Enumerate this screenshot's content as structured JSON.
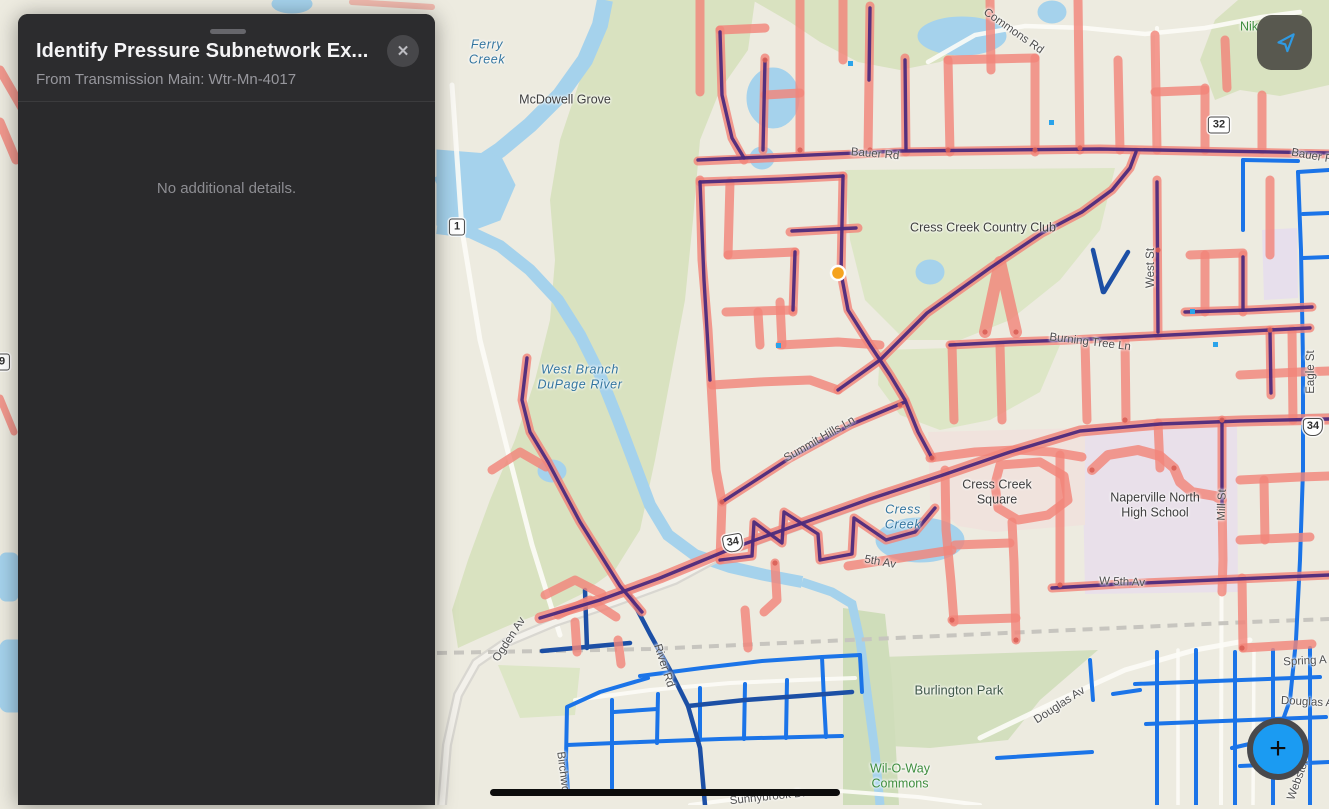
{
  "panel": {
    "title": "Identify Pressure Subnetwork Ex...",
    "subtitle": "From Transmission Main: Wtr-Mn-4017",
    "close_label": "✕",
    "body_text": "No additional details."
  },
  "controls": {
    "locate_icon": "navigation-arrow",
    "add_label": "+"
  },
  "map": {
    "marker_color": "#f5a31f",
    "colors": {
      "subnetwork_highlight": "#f2857a",
      "pressure_main_purple": "#4d2a7c",
      "water_main_blue": "#1b74e8",
      "water_main_navy": "#1c4fa5",
      "accent_blue": "#1b9bf2"
    },
    "shields": {
      "route_1": "1",
      "route_32": "32",
      "route_34": "34",
      "route_9": "9"
    },
    "labels": {
      "ferry_creek": "Ferry Creek",
      "mcdowell_grove": "McDowell Grove",
      "cress_creek_country_club": "Cress Creek Country Club",
      "west_branch_dupage_river": "West Branch DuPage River",
      "cress_creek": "Cress Creek",
      "cress_creek_square": "Cress Creek Square",
      "naperville_north_high_school": "Naperville North High School",
      "burlington_park": "Burlington Park",
      "wil_o_way_commons": "Wil-O-Way Commons",
      "commons_rd": "Commons Rd",
      "bauer_rd": "Bauer Rd",
      "bauer_rd_east": "Bauer R",
      "burning_tree_ln": "Burning Tree Ln",
      "summit_hills_ln": "Summit Hills Ln",
      "fifth_av": "5th Av",
      "w_fifth_av": "W 5th Av",
      "ogden_av": "Ogden Av",
      "river_rd": "River Rd",
      "douglas_av": "Douglas Av",
      "douglas_av_east": "Douglas A",
      "spring_av": "Spring A",
      "west_st": "West St",
      "eagle_st": "Eagle St",
      "mill_st": "Mill St",
      "birchwood_dr": "Birchwo",
      "sunnybrook_dr": "Sunnybrook Dr",
      "nike_park": "Nik",
      "webster_st": "Webster"
    }
  }
}
